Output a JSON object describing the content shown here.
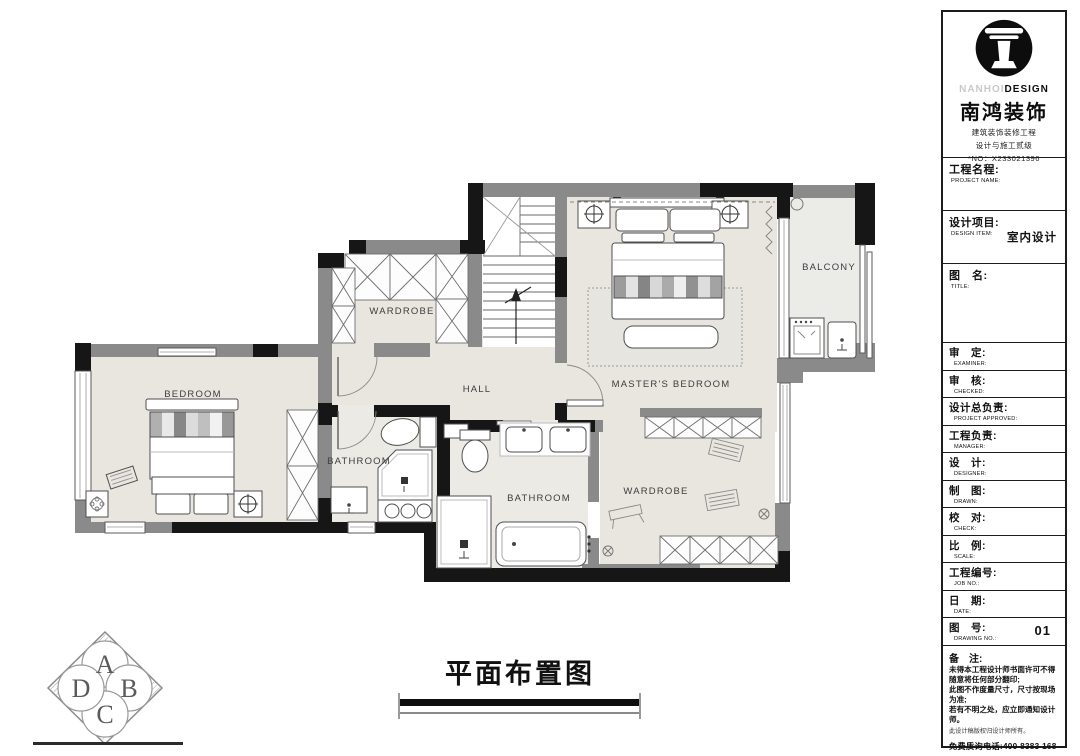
{
  "sheet": {
    "drawing_title": "平面布置图"
  },
  "logo_block": {
    "brand_en_light": "NANHOI",
    "brand_en_bold": "DESIGN",
    "brand_zh": "南鸿装饰",
    "sub1": "建筑装饰装修工程",
    "sub2": "设计与施工贰级",
    "license_no": "*NO：X233021396"
  },
  "titleblock": {
    "project_name": {
      "zh": "工程名程:",
      "en": "PROJECT NAME:"
    },
    "design_item": {
      "zh": "设计项目:",
      "en": "DESIGN ITEM:",
      "value": "室内设计"
    },
    "drawing_name": {
      "zh": "图　名:",
      "en": "TITLE:"
    },
    "rows": [
      {
        "zh": "审　定:",
        "en": "EXAMINER:",
        "value": ""
      },
      {
        "zh": "审　核:",
        "en": "CHECKED:",
        "value": ""
      },
      {
        "zh": "设计总负责:",
        "en": "PROJECT APPROVED:",
        "value": ""
      },
      {
        "zh": "工程负责:",
        "en": "MANAGER:",
        "value": ""
      },
      {
        "zh": "设　计:",
        "en": "DESIGNER:",
        "value": ""
      },
      {
        "zh": "制　图:",
        "en": "DRAWN:",
        "value": ""
      },
      {
        "zh": "校　对:",
        "en": "CHECK:",
        "value": ""
      },
      {
        "zh": "比　例:",
        "en": "SCALE:",
        "value": ""
      },
      {
        "zh": "工程编号:",
        "en": "JOB  NO.:",
        "value": ""
      },
      {
        "zh": "日　期:",
        "en": "DATE:",
        "value": ""
      },
      {
        "zh": "图　号:",
        "en": "DRAWING NO.:",
        "value": "01"
      }
    ],
    "notes": {
      "title": "备　注:",
      "lines": [
        "未得本工程设计师书面许可不得",
        "随意将任何部分翻印;",
        "此图不作度量尺寸，尺寸按现场",
        "为准;",
        "若有不明之处，应立即通知设计",
        "师。",
        "此设计稿版权归设计师所有。"
      ],
      "phone": "免费质询电话:400 8383 168"
    }
  },
  "plan": {
    "rooms": {
      "bedroom": "BEDROOM",
      "wardrobe1": "WARDROBE",
      "hall": "HALL",
      "master_bedroom": "MASTER'S BEDROOM",
      "balcony": "BALCONY",
      "bathroom1": "BATHROOM",
      "bathroom2": "BATHROOM",
      "wardrobe2": "WARDROBE"
    },
    "stairs_direction": "up"
  },
  "corner_logo": {
    "letters": [
      "A",
      "B",
      "C",
      "D"
    ]
  },
  "colors": {
    "wall_black": "#161616",
    "wall_gray": "#8a8a8a",
    "floor": "#e9e6e0",
    "balcony_floor": "#ebebe8",
    "accent_text": "#111111"
  }
}
